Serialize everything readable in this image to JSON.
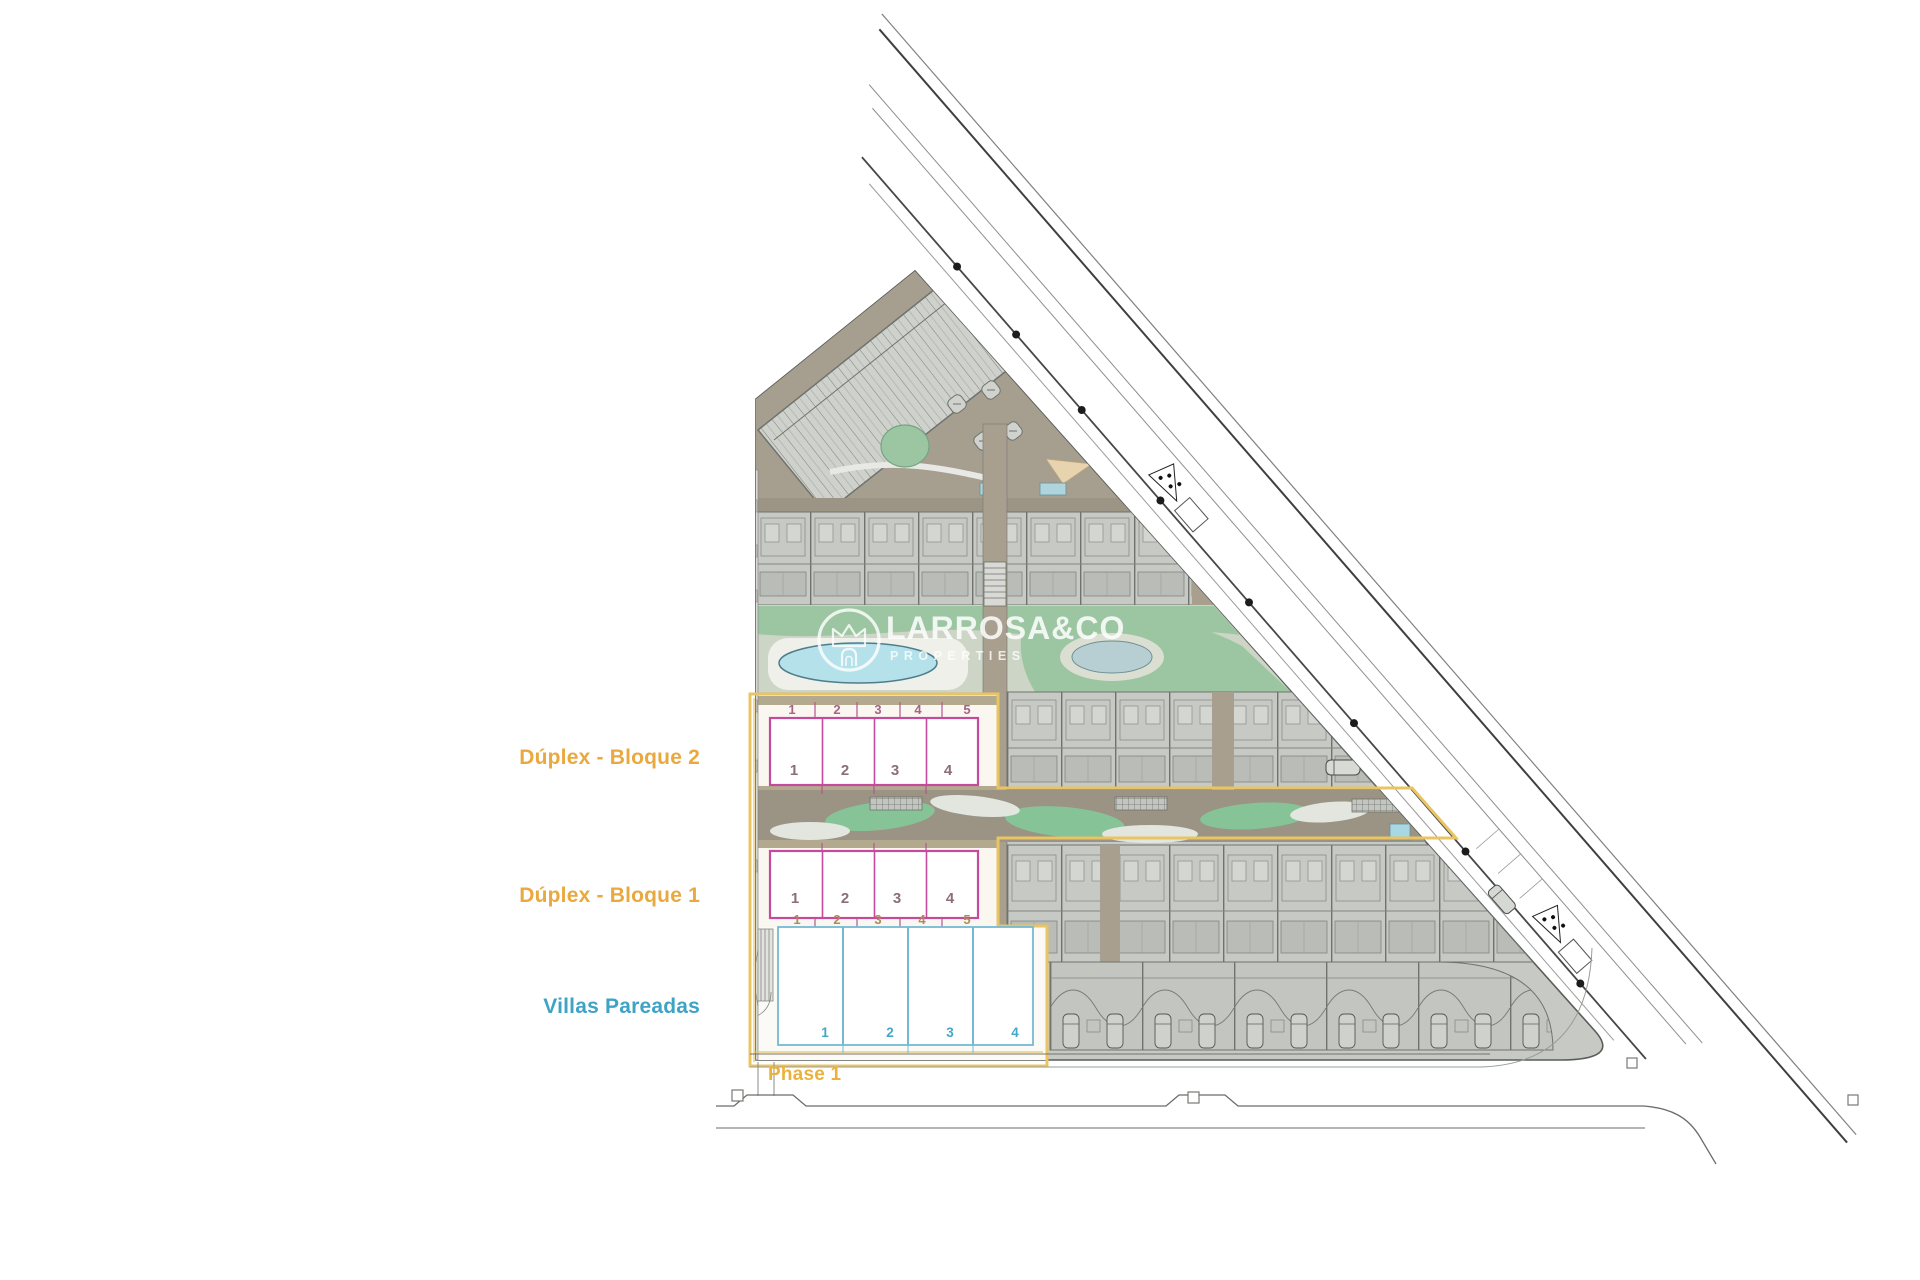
{
  "watermark": {
    "brand": "LARROSA&CO",
    "tagline": "PROPERTIES",
    "logo": "crown-m-logo"
  },
  "labels": {
    "duplex_block_2": "Dúplex - Bloque 2",
    "duplex_block_1": "Dúplex - Bloque 1",
    "villas": "Villas Pareadas",
    "phase": "Phase 1"
  },
  "blocks": {
    "duplex_block_2": {
      "plot_numbers": [
        "1",
        "2",
        "3",
        "4",
        "5"
      ],
      "unit_numbers": [
        "1",
        "2",
        "3",
        "4"
      ]
    },
    "duplex_block_1": {
      "unit_numbers": [
        "1",
        "2",
        "3",
        "4"
      ],
      "plot_numbers": [
        "1",
        "2",
        "3",
        "4",
        "5"
      ]
    },
    "villas": {
      "unit_numbers": [
        "1",
        "2",
        "3",
        "4"
      ]
    }
  },
  "colors": {
    "phase_outline": "#e9c463",
    "duplex_outline": "#c64a9c",
    "villas_outline": "#74bad4",
    "label_orange": "#e9a93f",
    "label_teal": "#3fa3c6",
    "phase_label": "#eab23c",
    "green_landscape": "#9cc6a1",
    "pool_blue": "#b4e1ea",
    "site_gray": "#c7c9c5",
    "circulation_tan": "#9b9383",
    "watermark_white": "#ffffff"
  }
}
